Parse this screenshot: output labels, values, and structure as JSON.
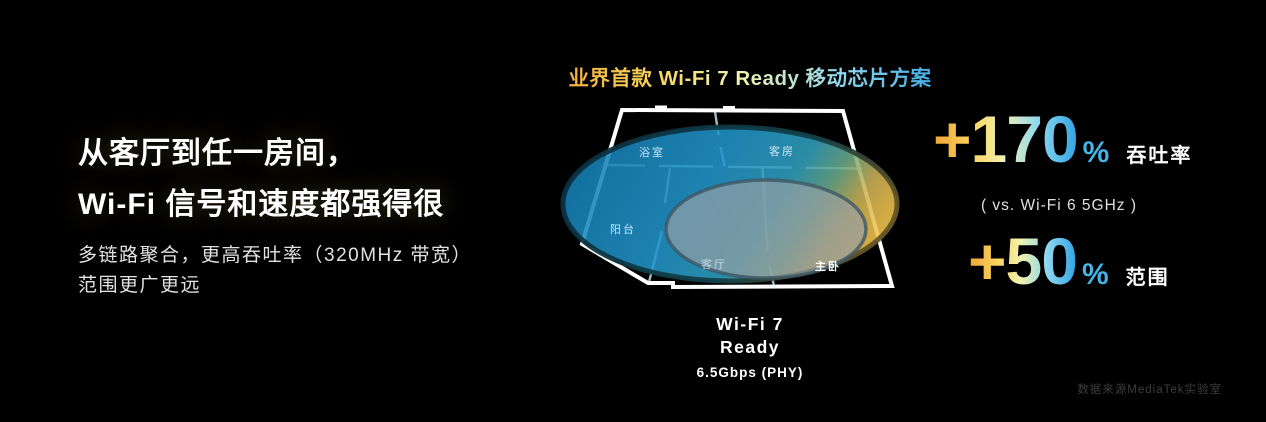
{
  "slide": {
    "left": {
      "heading_line1": "从客厅到任一房间，",
      "heading_line2": "Wi-Fi 信号和速度都强得很",
      "sub_line1": "多链路聚合，更高吞吐率（320MHz 带宽）",
      "sub_line2": "范围更广更远"
    },
    "center": {
      "title": "业界首款 Wi-Fi 7 Ready 移动芯片方案",
      "rooms": [
        "浴室",
        "客房",
        "阳台",
        "客厅",
        "主卧"
      ],
      "caption_line1": "Wi-Fi 7",
      "caption_line2": "Ready",
      "caption_sub": "6.5Gbps (PHY)"
    },
    "right": {
      "stat1_value": "+170",
      "stat1_unit": "%",
      "stat1_label": "吞吐率",
      "note": "( vs. Wi-Fi 6 5GHz )",
      "stat2_value": "+50",
      "stat2_unit": "%",
      "stat2_label": "范围"
    },
    "footer": "数据来源MediaTek实验室",
    "colors": {
      "accent_gradient_start": "#f0a435",
      "accent_gradient_end": "#2fa3e2",
      "percent_color": "#45b4e8",
      "coverage_blue": "#2295c9",
      "coverage_yellow": "#f0c14e",
      "inner_coverage_gray": "#98a1a7"
    }
  }
}
